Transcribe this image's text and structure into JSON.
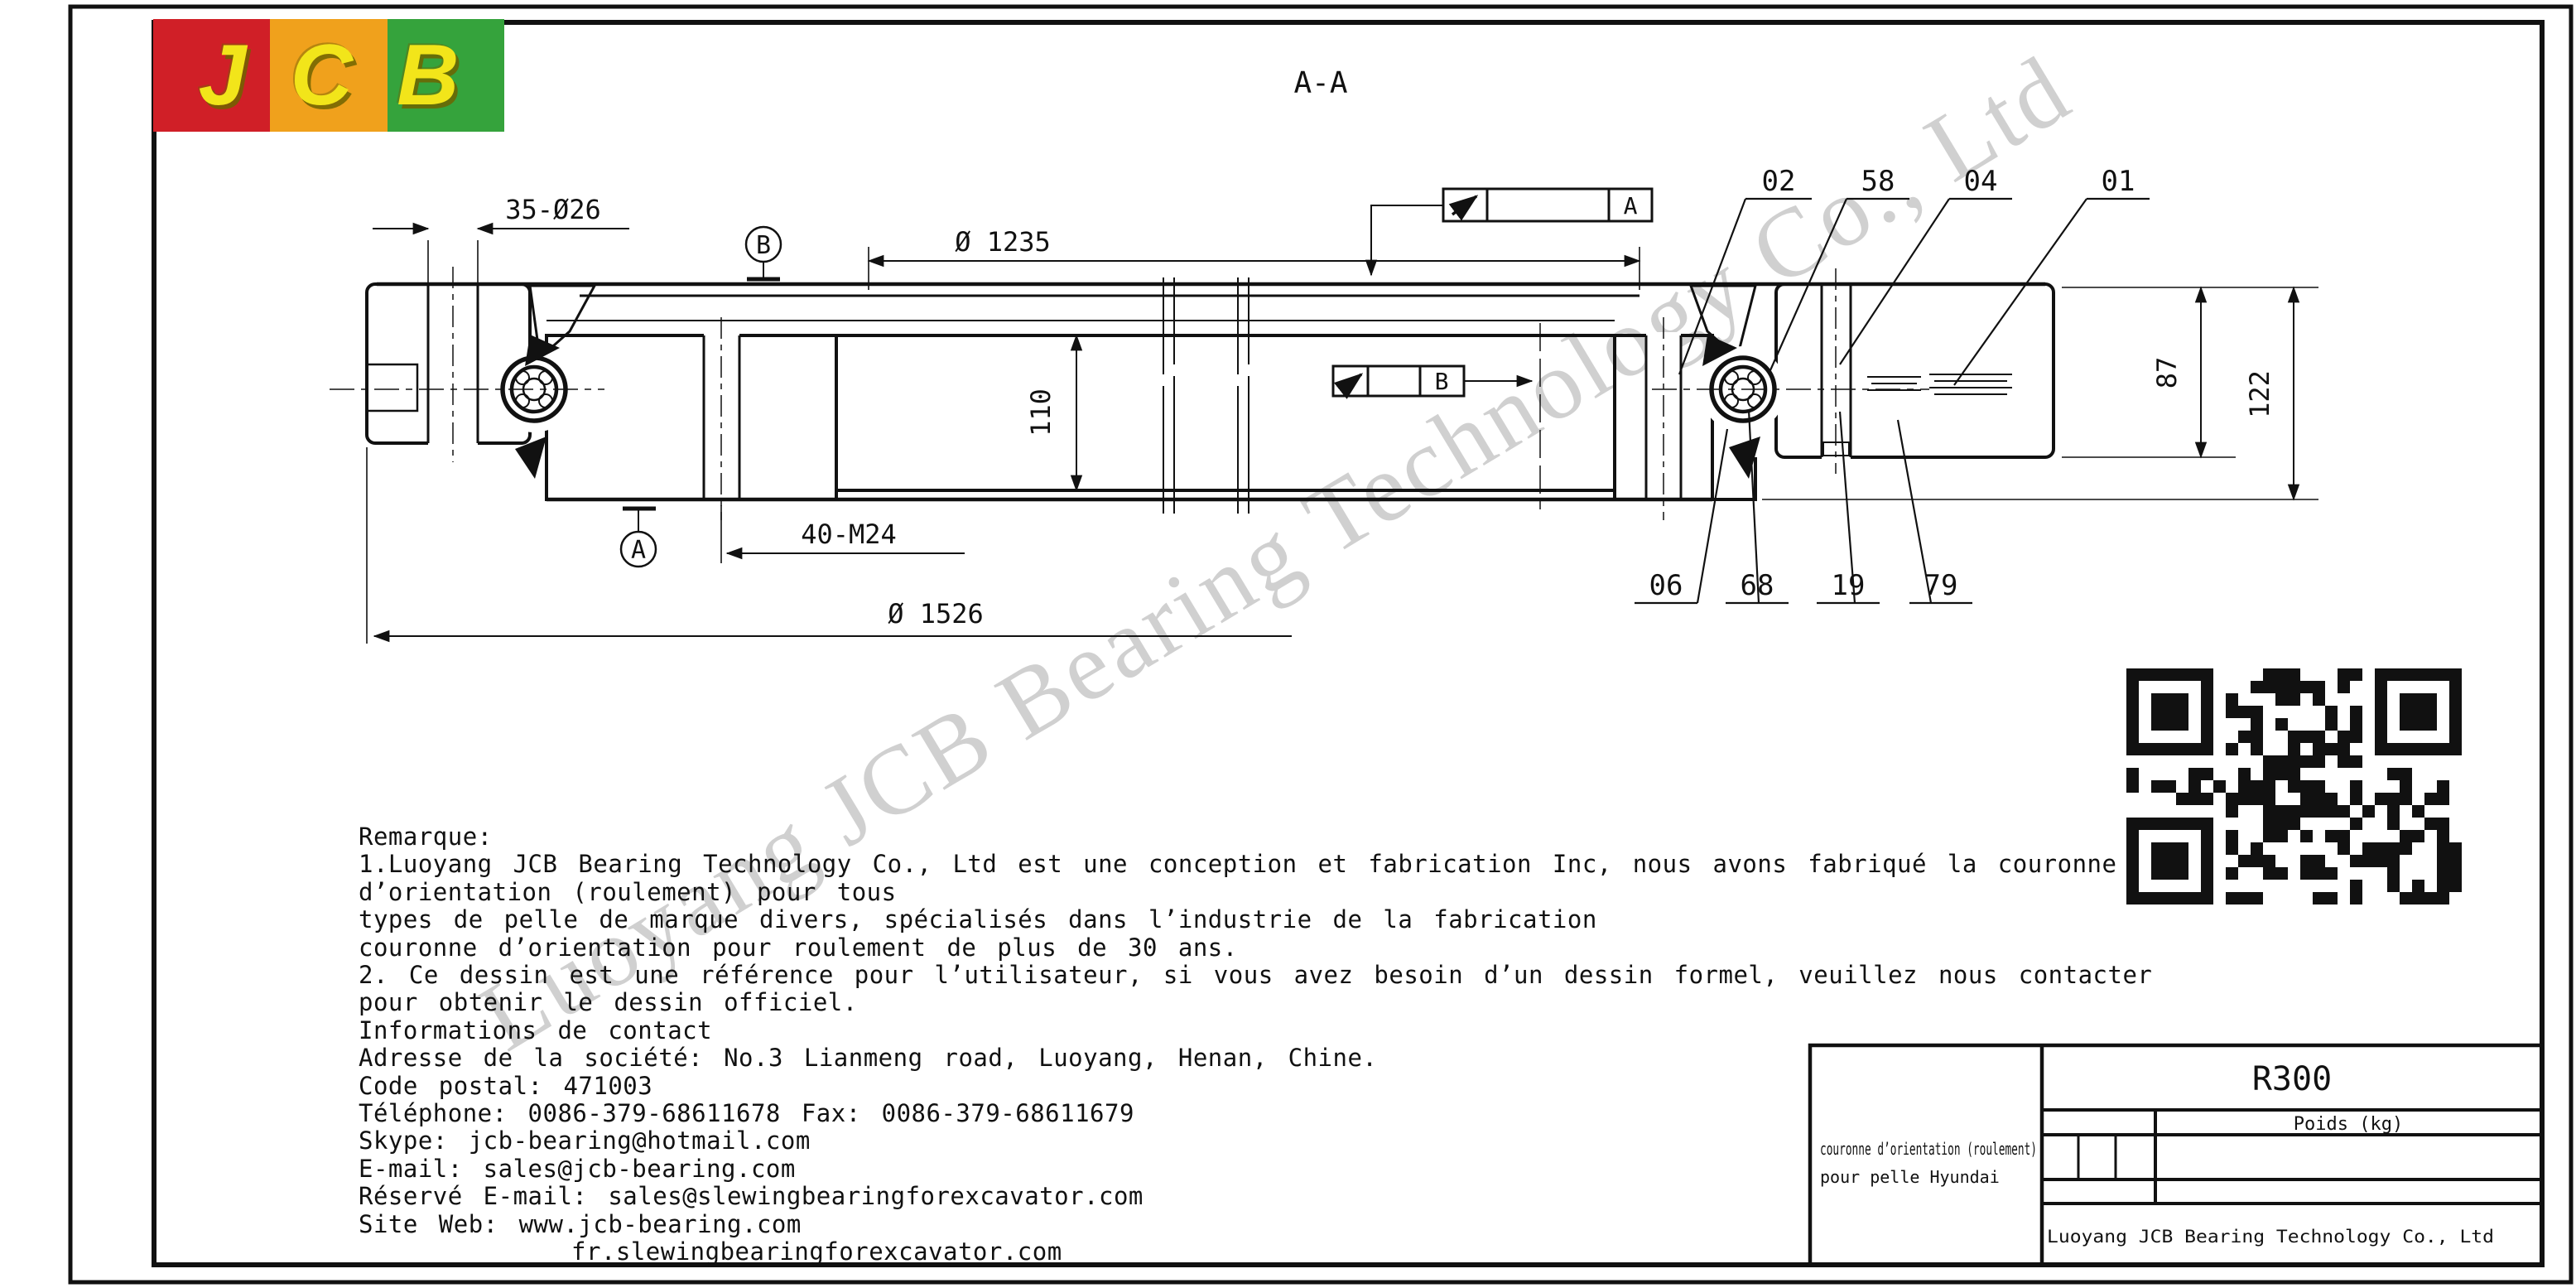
{
  "logo": {
    "letters": [
      "J",
      "C",
      "B"
    ],
    "colors": {
      "red": "#d01f27",
      "orange": "#f0a11c",
      "green": "#35a33c",
      "letters": "#f2e51a"
    }
  },
  "watermark": {
    "text": "Luoyang JCB Bearing Technology Co., Ltd",
    "color": "#9e9e9e"
  },
  "drawing": {
    "section_title": "A-A",
    "dimensions": {
      "bolt_holes_outer": "35-Ø26",
      "inner_diameter": "Ø 1235",
      "bore_height": "110",
      "bolt_thread_inner": "40-M24",
      "outer_diameter": "Ø 1526",
      "outer_ring_height": "87",
      "total_height": "122"
    },
    "datums": {
      "a": "A",
      "b": "B"
    },
    "tolerance_frames": [
      {
        "datum": "A"
      },
      {
        "datum": "B"
      }
    ],
    "callouts_top": [
      "02",
      "58",
      "04",
      "01"
    ],
    "callouts_bottom": [
      "06",
      "68",
      "19",
      "79"
    ]
  },
  "remarks": {
    "lines": [
      "Remarque:",
      "1.Luoyang JCB Bearing Technology Co., Ltd est une conception et fabrication Inc, nous avons fabriqué la couronne",
      "d’orientation (roulement) pour tous",
      "types de pelle de marque divers, spécialisés dans l’industrie de la fabrication",
      "couronne d’orientation pour roulement de plus de 30 ans.",
      "2. Ce dessin est une référence pour l’utilisateur, si vous avez besoin d’un dessin formel, veuillez nous contacter",
      "pour obtenir le dessin officiel.",
      "Informations de contact",
      "Adresse de la société: No.3 Lianmeng road, Luoyang, Henan, Chine.",
      "Code postal: 471003",
      "Téléphone: 0086-379-68611678 Fax: 0086-379-68611679",
      "Skype: jcb-bearing@hotmail.com",
      "E-mail: sales@jcb-bearing.com",
      "Réservé E-mail: sales@slewingbearingforexcavator.com",
      "Site Web: www.jcb-bearing.com",
      "fr.slewingbearingforexcavator.com"
    ]
  },
  "title_block": {
    "model": "R300",
    "weight_label": "Poids (kg)",
    "description_line1": "couronne d’orientation (roulement)",
    "description_line2": "pour pelle Hyundai",
    "company": "Luoyang JCB Bearing Technology Co., Ltd"
  }
}
